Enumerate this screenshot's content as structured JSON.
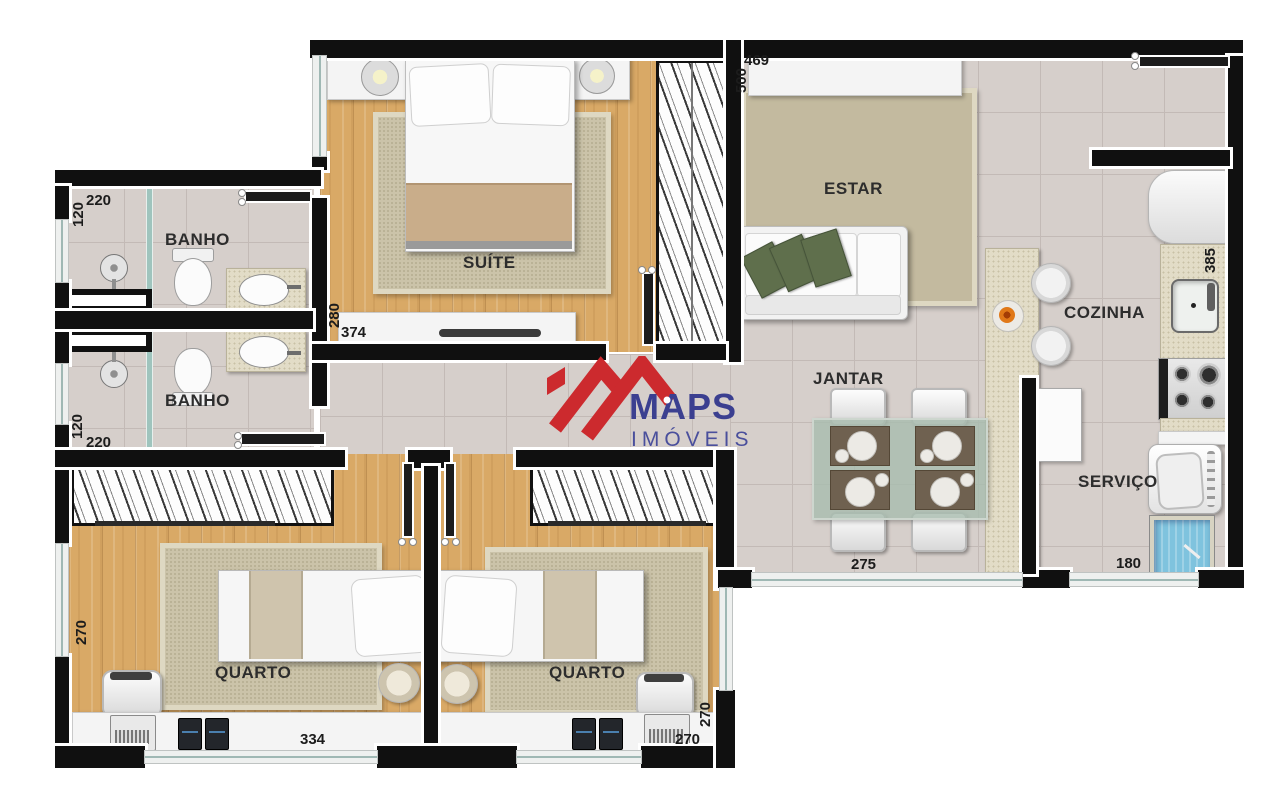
{
  "plan": {
    "rooms": {
      "banho_top": "BANHO",
      "banho_bottom": "BANHO",
      "suite": "SUÍTE",
      "estar": "ESTAR",
      "cozinha": "COZINHA",
      "jantar": "JANTAR",
      "servico": "SERVIÇO",
      "quarto_left": "QUARTO",
      "quarto_right": "QUARTO"
    },
    "dims": {
      "banho_top_w": "220",
      "banho_top_h": "120",
      "suite_h": "280",
      "suite_w": "374",
      "estar_w": "469",
      "estar_h": "500",
      "cozinha_h": "385",
      "jantar_w": "275",
      "servico_w": "180",
      "banho_bottom_h": "120",
      "banho_bottom_w": "220",
      "quarto_left_h": "270",
      "quarto_left_w": "334",
      "quarto_right_w": "270",
      "quarto_right_h": "270"
    }
  },
  "logo": {
    "brand": "MAPS",
    "tagline": "IMÓVEIS"
  },
  "colors": {
    "wall": "#101010",
    "wood_floor": "#d9a966",
    "tile_floor": "#d6cfcb",
    "rug": "#cbc3a9",
    "logo_red": "#cc2a2e",
    "logo_blue": "#3b3f90",
    "glass_table": "#a9bcae",
    "laundry_tank_blue": "#7fc3de",
    "pillow_green": "#5f6f4c"
  }
}
